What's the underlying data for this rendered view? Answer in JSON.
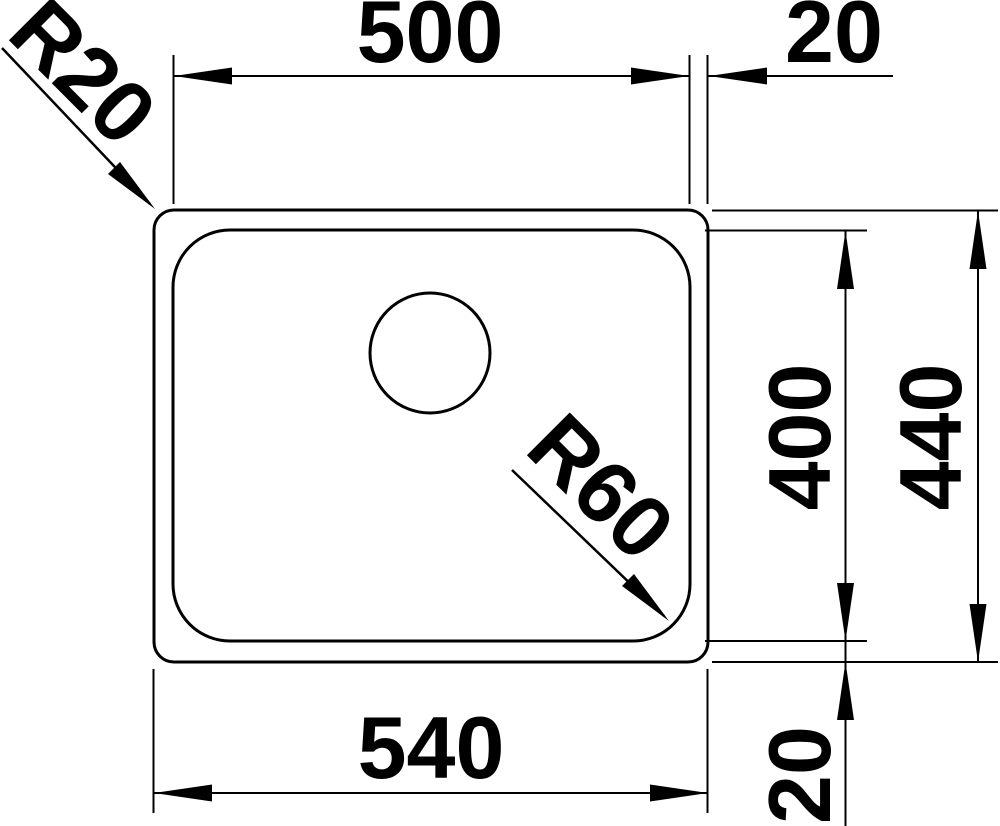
{
  "drawing": {
    "kind": "technical-dimension-drawing",
    "view": "sink-top-view",
    "colors": {
      "line": "#000000",
      "background": "#ffffff"
    },
    "labels": {
      "inner_width": "500",
      "rim_offset_top": "20",
      "outer_corner_radius": "R20",
      "inner_corner_radius": "R60",
      "inner_depth": "400",
      "outer_depth": "440",
      "outer_width": "540",
      "rim_offset_bottom": "20"
    }
  }
}
